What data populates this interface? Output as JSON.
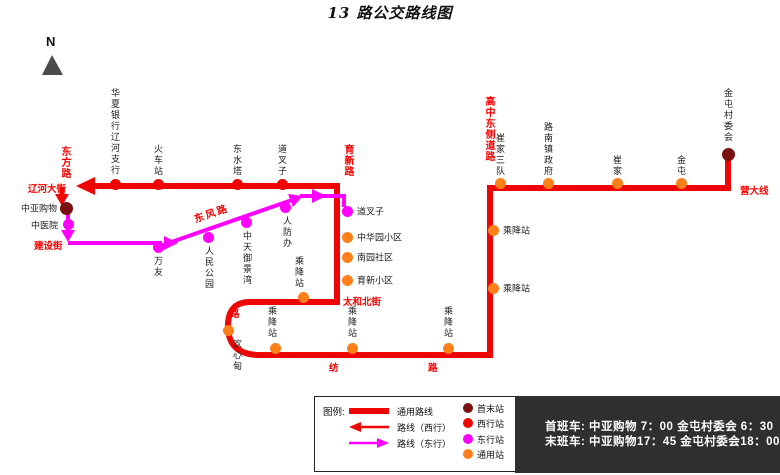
{
  "title": "13 路公交路线图",
  "compass": {
    "label": "N"
  },
  "colors": {
    "route_common": "#ee0505",
    "route_east": "#ff00ff",
    "stop_terminal": "#7a0f0f",
    "stop_west": "#f50000",
    "stop_east": "#ff00ff",
    "stop_common": "#ff7f1a",
    "street_text": "#f80000",
    "schedule_bg": "#2f2f2f"
  },
  "map": {
    "stations": [
      {
        "name": "华夏银行辽河支行",
        "type": "west",
        "x": 115,
        "y": 184,
        "label": {
          "o": "v",
          "x": 115,
          "y": 88
        }
      },
      {
        "name": "火车站",
        "type": "west",
        "x": 158,
        "y": 184,
        "label": {
          "o": "v",
          "x": 158,
          "y": 144
        }
      },
      {
        "name": "东水塔",
        "type": "west",
        "x": 237,
        "y": 184,
        "label": {
          "o": "v",
          "x": 237,
          "y": 144
        }
      },
      {
        "name": "道叉子",
        "type": "west",
        "x": 282,
        "y": 184,
        "label": {
          "o": "v",
          "x": 282,
          "y": 144
        }
      },
      {
        "name": "中亚购物",
        "type": "terminal",
        "x": 66,
        "y": 208,
        "label": {
          "o": "h",
          "x": 57,
          "y": 208,
          "align": "r"
        }
      },
      {
        "name": "中医院",
        "type": "east",
        "x": 68,
        "y": 224,
        "label": {
          "o": "h",
          "x": 58,
          "y": 225,
          "align": "r"
        }
      },
      {
        "name": "万友",
        "type": "east",
        "x": 158,
        "y": 247,
        "label": {
          "o": "v",
          "x": 158,
          "y": 256
        }
      },
      {
        "name": "人民公园",
        "type": "east",
        "x": 208,
        "y": 237,
        "label": {
          "o": "v",
          "x": 209,
          "y": 246
        }
      },
      {
        "name": "中天御景湾",
        "type": "east",
        "x": 246,
        "y": 222,
        "label": {
          "o": "v",
          "x": 247,
          "y": 231
        }
      },
      {
        "name": "人防办",
        "type": "east",
        "x": 285,
        "y": 207,
        "label": {
          "o": "v",
          "x": 287,
          "y": 216
        }
      },
      {
        "name": "道叉子",
        "type": "east",
        "x": 347,
        "y": 211,
        "label": {
          "o": "h",
          "x": 357,
          "y": 211
        }
      },
      {
        "name": "中华园小区",
        "type": "common",
        "x": 347,
        "y": 237,
        "label": {
          "o": "h",
          "x": 357,
          "y": 237
        }
      },
      {
        "name": "南园社区",
        "type": "common",
        "x": 347,
        "y": 257,
        "label": {
          "o": "h",
          "x": 357,
          "y": 257
        }
      },
      {
        "name": "育新小区",
        "type": "common",
        "x": 347,
        "y": 280,
        "label": {
          "o": "h",
          "x": 357,
          "y": 280
        }
      },
      {
        "name": "乘降站",
        "type": "common",
        "x": 303,
        "y": 297,
        "label": {
          "o": "v",
          "x": 299,
          "y": 256
        }
      },
      {
        "name": "欢心甸",
        "type": "common",
        "x": 228,
        "y": 330,
        "label": {
          "o": "v",
          "x": 237,
          "y": 339
        }
      },
      {
        "name": "乘降站",
        "type": "common",
        "x": 275,
        "y": 348,
        "label": {
          "o": "v",
          "x": 272,
          "y": 306
        }
      },
      {
        "name": "乘降站",
        "type": "common",
        "x": 352,
        "y": 348,
        "label": {
          "o": "v",
          "x": 352,
          "y": 306
        }
      },
      {
        "name": "乘降站",
        "type": "common",
        "x": 448,
        "y": 348,
        "label": {
          "o": "v",
          "x": 448,
          "y": 306
        }
      },
      {
        "name": "乘降站",
        "type": "common",
        "x": 493,
        "y": 288,
        "label": {
          "o": "h",
          "x": 503,
          "y": 288
        }
      },
      {
        "name": "乘降站",
        "type": "common",
        "x": 493,
        "y": 230,
        "label": {
          "o": "h",
          "x": 503,
          "y": 230
        }
      },
      {
        "name": "崔家三队",
        "type": "common",
        "x": 500,
        "y": 183,
        "label": {
          "o": "v",
          "x": 500,
          "y": 133
        }
      },
      {
        "name": "路南镇政府",
        "type": "common",
        "x": 548,
        "y": 183,
        "label": {
          "o": "v",
          "x": 548,
          "y": 122
        }
      },
      {
        "name": "崔家",
        "type": "common",
        "x": 617,
        "y": 183,
        "label": {
          "o": "v",
          "x": 617,
          "y": 155
        }
      },
      {
        "name": "金屯",
        "type": "common",
        "x": 681,
        "y": 183,
        "label": {
          "o": "v",
          "x": 681,
          "y": 155
        }
      },
      {
        "name": "金屯村委会",
        "type": "terminal",
        "x": 728,
        "y": 154,
        "label": {
          "o": "v",
          "x": 728,
          "y": 88
        }
      }
    ],
    "streets": [
      {
        "name": "东方路",
        "o": "v",
        "x": 64,
        "y": 146
      },
      {
        "name": "辽河大街",
        "o": "h",
        "x": 28,
        "y": 181
      },
      {
        "name": "建设街",
        "o": "h",
        "x": 34,
        "y": 238
      },
      {
        "name": "东风路",
        "o": "r",
        "x": 193,
        "y": 205
      },
      {
        "name": "育新路",
        "o": "v",
        "x": 347,
        "y": 144
      },
      {
        "name": "太和北街",
        "o": "h",
        "x": 343,
        "y": 294
      },
      {
        "name": "纺",
        "o": "h",
        "x": 329,
        "y": 360
      },
      {
        "name": "路",
        "o": "h",
        "x": 428,
        "y": 360
      },
      {
        "name": "路",
        "o": "h",
        "x": 230,
        "y": 306
      },
      {
        "name": "高中东侧道路",
        "o": "v",
        "x": 488,
        "y": 96
      },
      {
        "name": "营大线",
        "o": "h",
        "x": 740,
        "y": 183
      }
    ]
  },
  "legend": {
    "title": "图例:",
    "lines": [
      {
        "label": "通用路线",
        "style": "bar"
      },
      {
        "label": "路线（西行）",
        "style": "arrow-west"
      },
      {
        "label": "路线（东行）",
        "style": "arrow-east"
      }
    ],
    "stops": [
      {
        "label": "首末站",
        "type": "terminal"
      },
      {
        "label": "西行站",
        "type": "west"
      },
      {
        "label": "东行站",
        "type": "east"
      },
      {
        "label": "通用站",
        "type": "common"
      }
    ]
  },
  "schedule": {
    "first": "首班车: 中亚购物 7：00  金屯村委会 6：30",
    "last": "末班车: 中亚购物17：45  金屯村委会18：00"
  }
}
